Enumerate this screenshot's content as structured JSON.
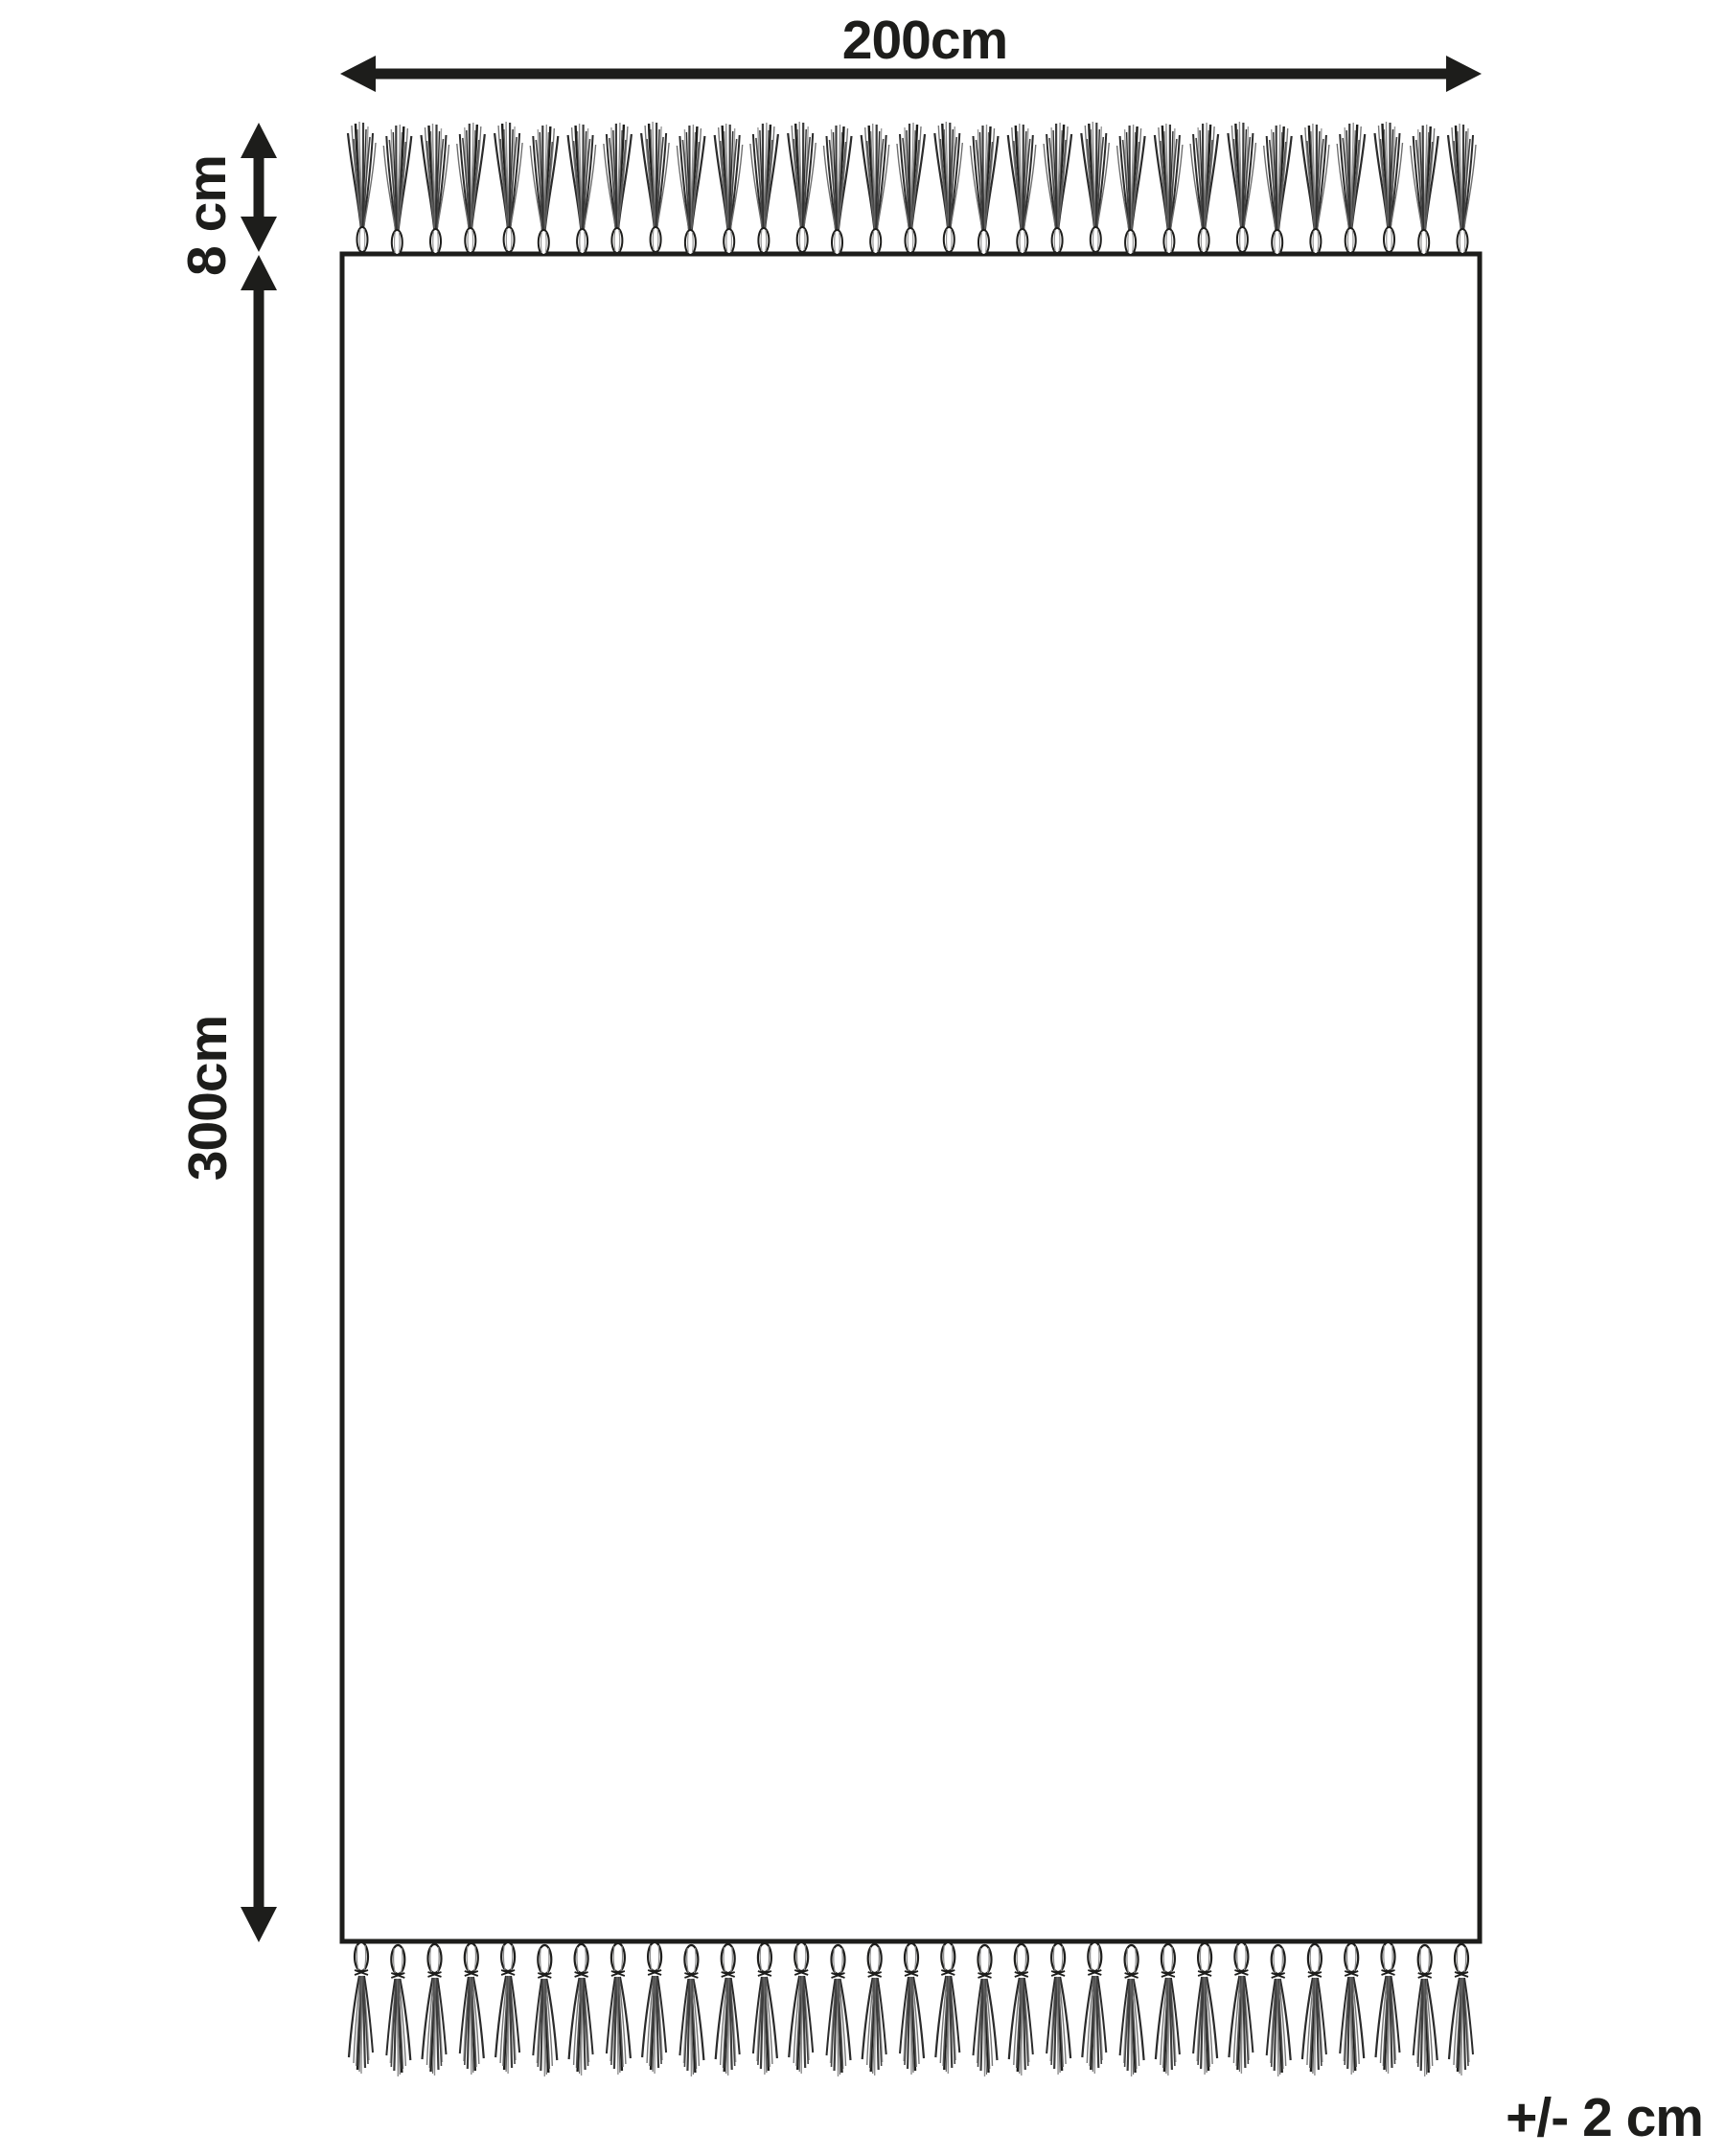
{
  "diagram": {
    "rug": {
      "width_label": "200cm",
      "height_label": "300cm",
      "fringe_length_label": "8 cm",
      "tolerance_label": "+/- 2 cm"
    },
    "fringe": {
      "top_count": 31,
      "bottom_count": 31
    },
    "arrows": {
      "width": "double-headed-horizontal-arrow",
      "height": "double-headed-vertical-arrow",
      "fringe": "double-headed-vertical-arrow"
    },
    "colors": {
      "ink": "#1d1d1b",
      "background": "#ffffff",
      "strand_dark": "#2b2b2b",
      "strand_mid": "#6f6f6f",
      "strand_light": "#9c9c9c"
    }
  }
}
